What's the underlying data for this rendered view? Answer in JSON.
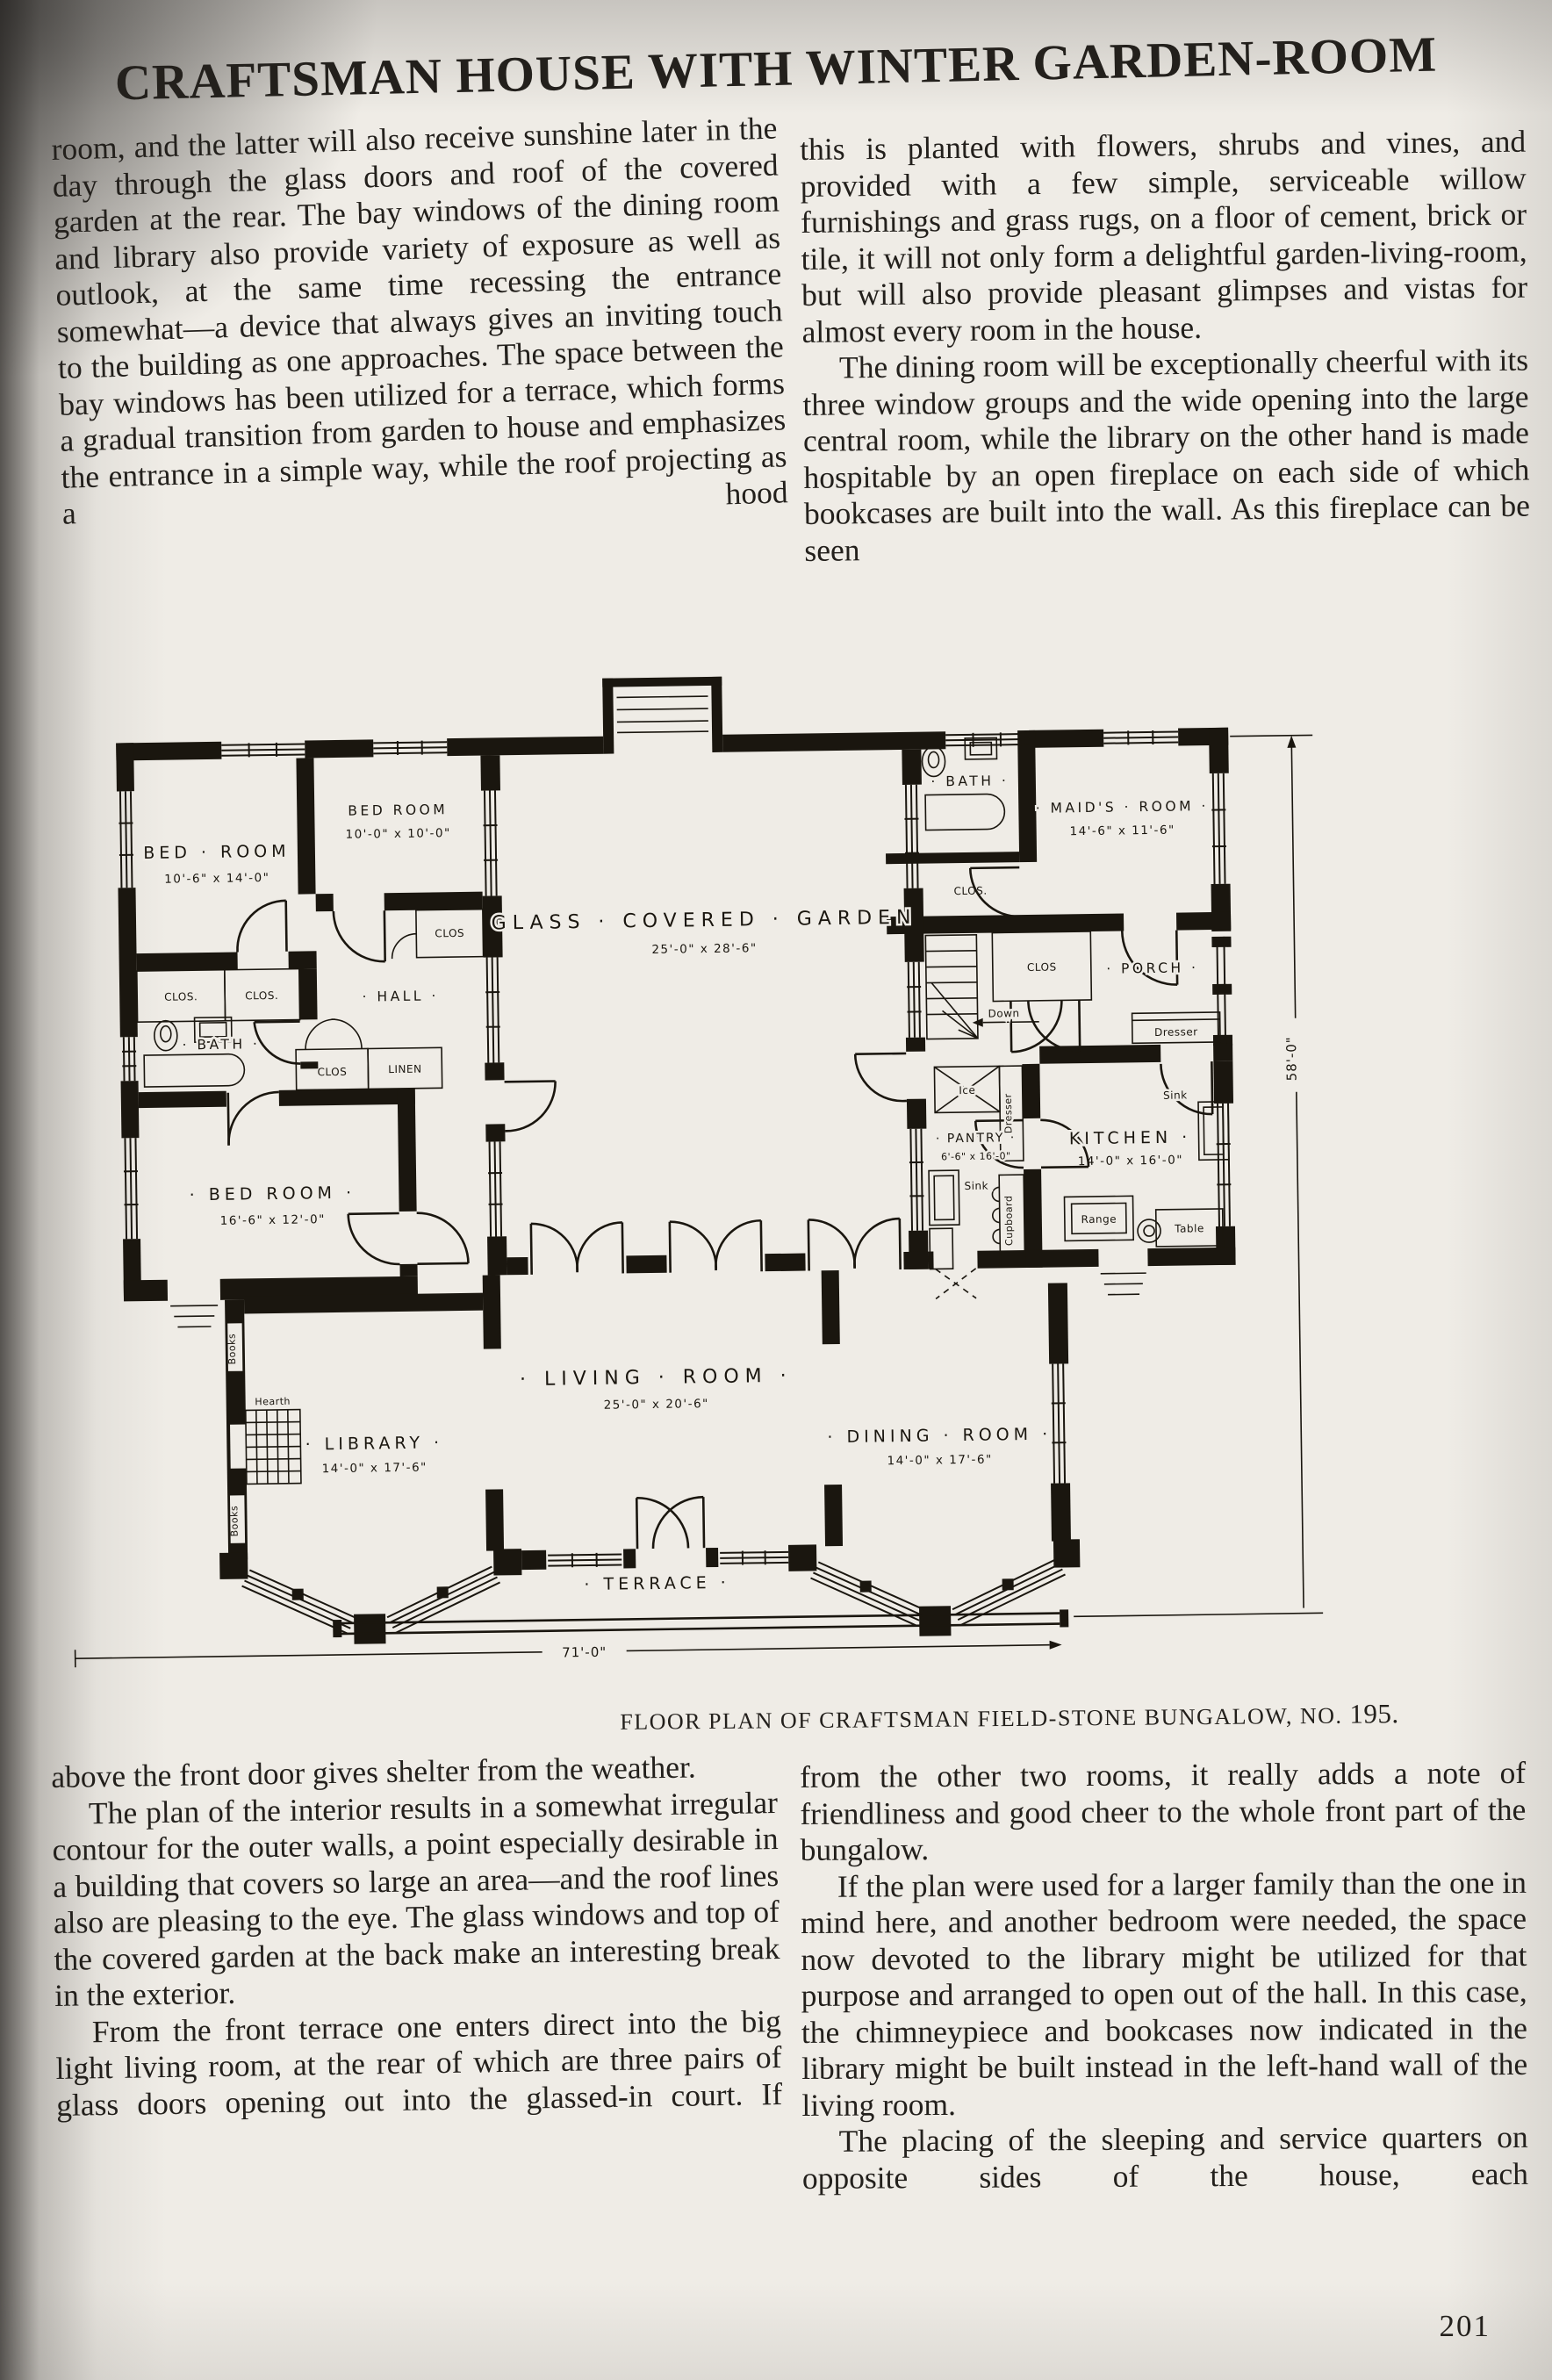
{
  "page": {
    "title": "CRAFTSMAN HOUSE WITH WINTER GARDEN-ROOM",
    "number": "201"
  },
  "caption": {
    "text": "FLOOR PLAN OF CRAFTSMAN FIELD-STONE BUNGALOW, NO.",
    "number": "195."
  },
  "article": {
    "col_top_left": {
      "p1": "room, and the latter will also receive sunshine later in the day through the glass doors and roof of the covered garden at the rear.  The bay windows of the dining room and library also provide variety of exposure as well as outlook, at the same time recessing the entrance somewhat—a device that always gives an inviting touch to the building as one approaches.  The space between the bay windows has been utilized for a terrace, which forms a gradual transition from garden to house and emphasizes the entrance in a simple way, while the roof projecting as a hood"
    },
    "col_top_right": {
      "p1": "this is planted with flowers, shrubs and vines, and provided with a few simple, serviceable willow furnishings and grass rugs, on a floor of cement, brick or tile, it will not only form a delightful garden-living-room, but will also provide pleasant glimpses and vistas for almost every room in the house.",
      "p2": "The dining room will be exceptionally cheerful with its three window groups and the wide opening into the large central room, while the library on the other hand is made hospitable by an open fireplace on each side of which bookcases are built into the wall.  As this fireplace can be seen"
    },
    "col_bottom_left": {
      "p1": "above the front door gives shelter from the weather.",
      "p2": "The plan of the interior results in a somewhat irregular contour for the outer walls, a point especially desirable in a building that covers so large an area—and the roof lines also are pleasing to the eye.  The glass windows and top of the covered garden at the back make an interesting break in the exterior.",
      "p3": "From the front terrace one enters direct into the big light living room, at the rear of which are three pairs of glass doors opening out into the glassed-in court.  If"
    },
    "col_bottom_right": {
      "p1": "from the other two rooms, it really adds a note of friendliness and good cheer to the whole front part of the bungalow.",
      "p2": "If the plan were used for a larger family than the one in mind here, and another bedroom were needed, the space now devoted to the library might be utilized for that purpose and arranged to open out of the hall.  In this case, the chimneypiece and bookcases now indicated in the library might be built instead in the left-hand wall of the living room.",
      "p3": "The placing of the sleeping and service quarters on opposite sides of the house, each"
    }
  },
  "plan": {
    "dimension_width": "71'-0\"",
    "dimension_height": "58'-0\"",
    "rooms": {
      "garden": {
        "name": "GLASS · COVERED · GARDEN",
        "dims": "25'-0\" x 28'-6\""
      },
      "living": {
        "name": "· LIVING · ROOM ·",
        "dims": "25'-0\" x 20'-6\""
      },
      "library": {
        "name": "· LIBRARY ·",
        "dims": "14'-0\" x 17'-6\""
      },
      "dining": {
        "name": "· DINING · ROOM ·",
        "dims": "14'-0\" x 17'-6\""
      },
      "terrace": {
        "name": "· TERRACE ·"
      },
      "bed1": {
        "name": "BED · ROOM",
        "dims": "10'-6\" x 14'-0\""
      },
      "bed2": {
        "name": "BED ROOM",
        "dims": "10'-0\" x 10'-0\""
      },
      "bed3": {
        "name": "· BED ROOM ·",
        "dims": "16'-6\" x 12'-0\""
      },
      "maids": {
        "name": "· MAID'S · ROOM ·",
        "dims": "14'-6\" x 11'-6\""
      },
      "kitchen": {
        "name": "KITCHEN ·",
        "dims": "14'-0\" x 16'-0\""
      },
      "pantry": {
        "name": "· PANTRY ·",
        "dims": "6'-6\" x 16'-0\""
      },
      "hall": {
        "name": "· HALL ·"
      },
      "bath1": {
        "name": "· BATH ·"
      },
      "bath2": {
        "name": "· BATH ·"
      },
      "porch": {
        "name": "· PORCH ·"
      }
    },
    "labels": {
      "clos_dot": "CLOS.",
      "clos": "CLOS",
      "linen": "LINEN",
      "books": "Books",
      "hearth": "Hearth",
      "down": "Down",
      "ice": "Ice",
      "sink": "Sink",
      "range": "Range",
      "table": "Table",
      "dresser": "Dresser",
      "cupboard": "Cupboard"
    }
  }
}
